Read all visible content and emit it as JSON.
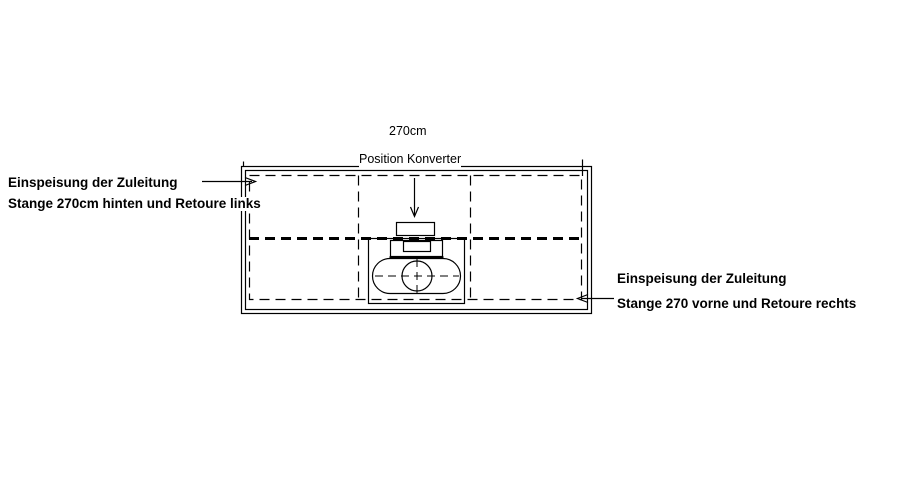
{
  "drawing": {
    "title": "Schrank-Grundriss mit Konverter-Position",
    "dimension_width_label": "270cm",
    "converter_position_label": "Position Konverter",
    "annotation_left": {
      "line1": "Einspeisung der Zuleitung",
      "line2": "Stange 270cm hinten und Retoure links"
    },
    "annotation_right": {
      "line1": "Einspeisung der Zuleitung",
      "line2": "Stange 270 vorne und Retoure rechts"
    },
    "colors": {
      "background": "#ffffff",
      "line": "#000000",
      "text": "#000000"
    }
  }
}
